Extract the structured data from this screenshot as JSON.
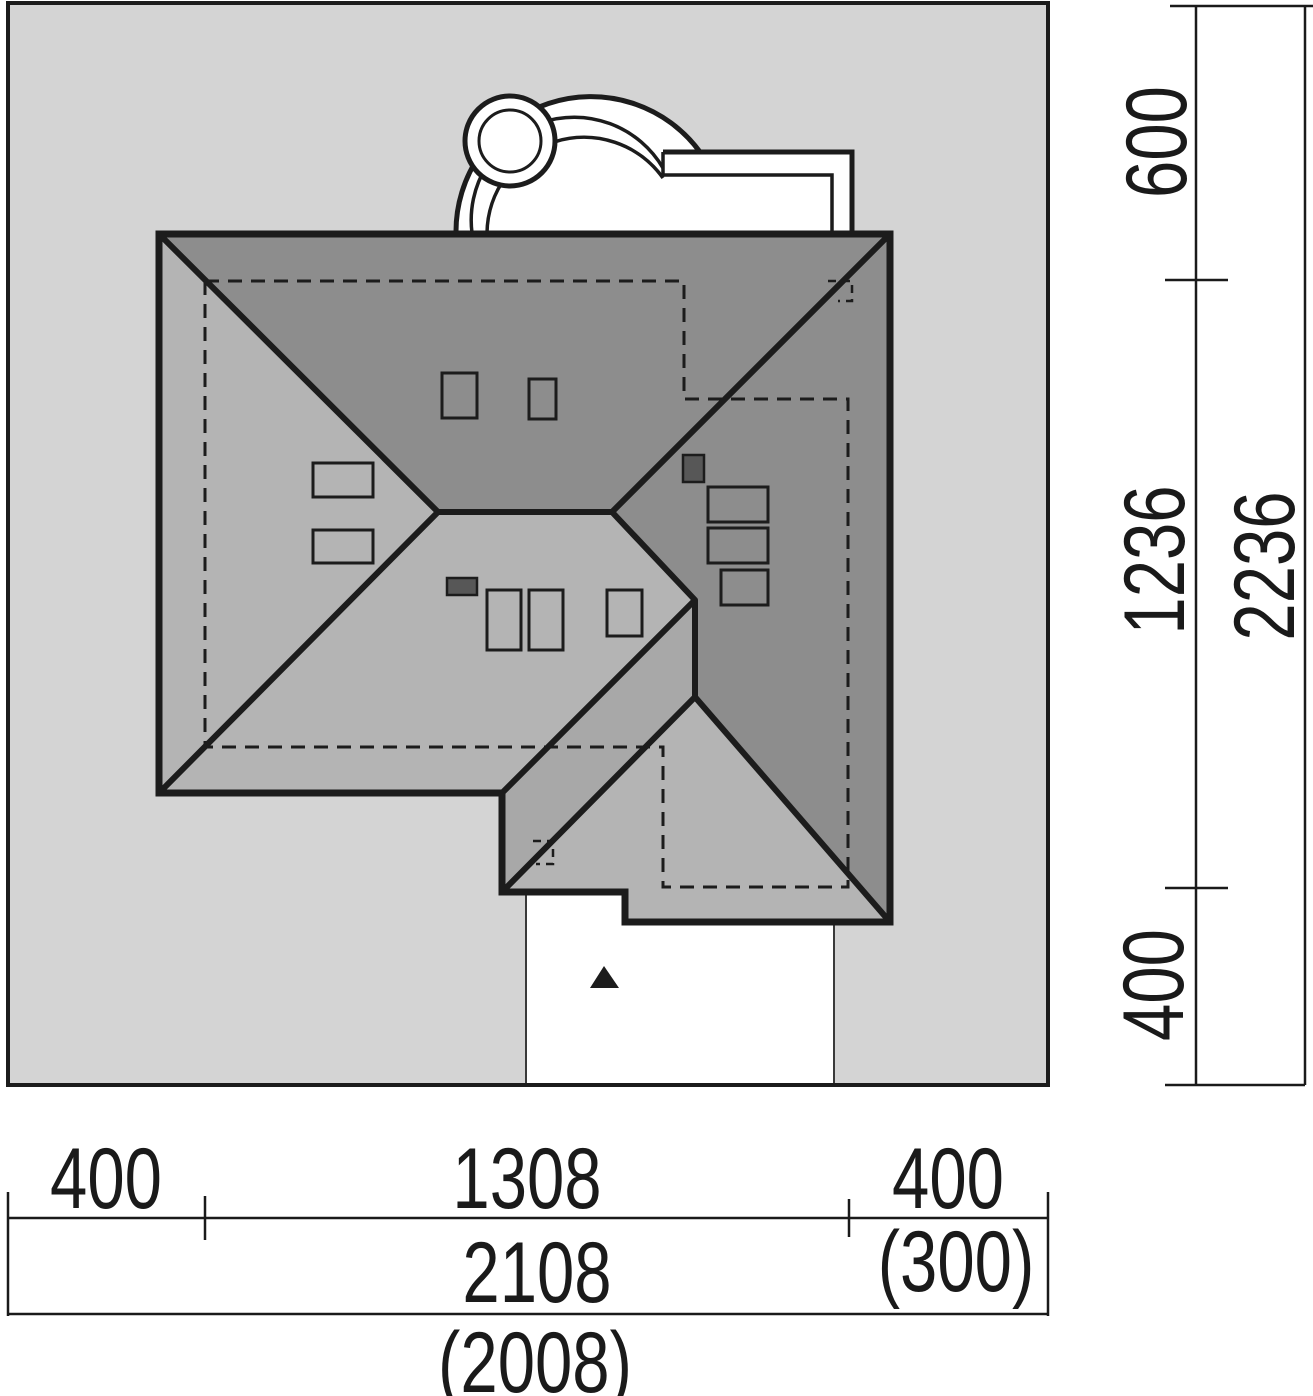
{
  "colors": {
    "plot_fill": "#d4d4d4",
    "roof_dark": "#8d8d8d",
    "roof_light": "#b4b4b4",
    "roof_mid": "#a8a8a8",
    "chimney": "#575757",
    "line": "#1c1c1c",
    "white": "#ffffff"
  },
  "dims": {
    "right": {
      "seg_top": "600",
      "seg_mid": "1236",
      "total": "2236",
      "seg_bottom": "400"
    },
    "bottom": {
      "seg_left": "400",
      "seg_mid": "1308",
      "seg_right": "400",
      "total": "2108",
      "alt_right": "(300)",
      "alt_total": "(2008)"
    }
  }
}
